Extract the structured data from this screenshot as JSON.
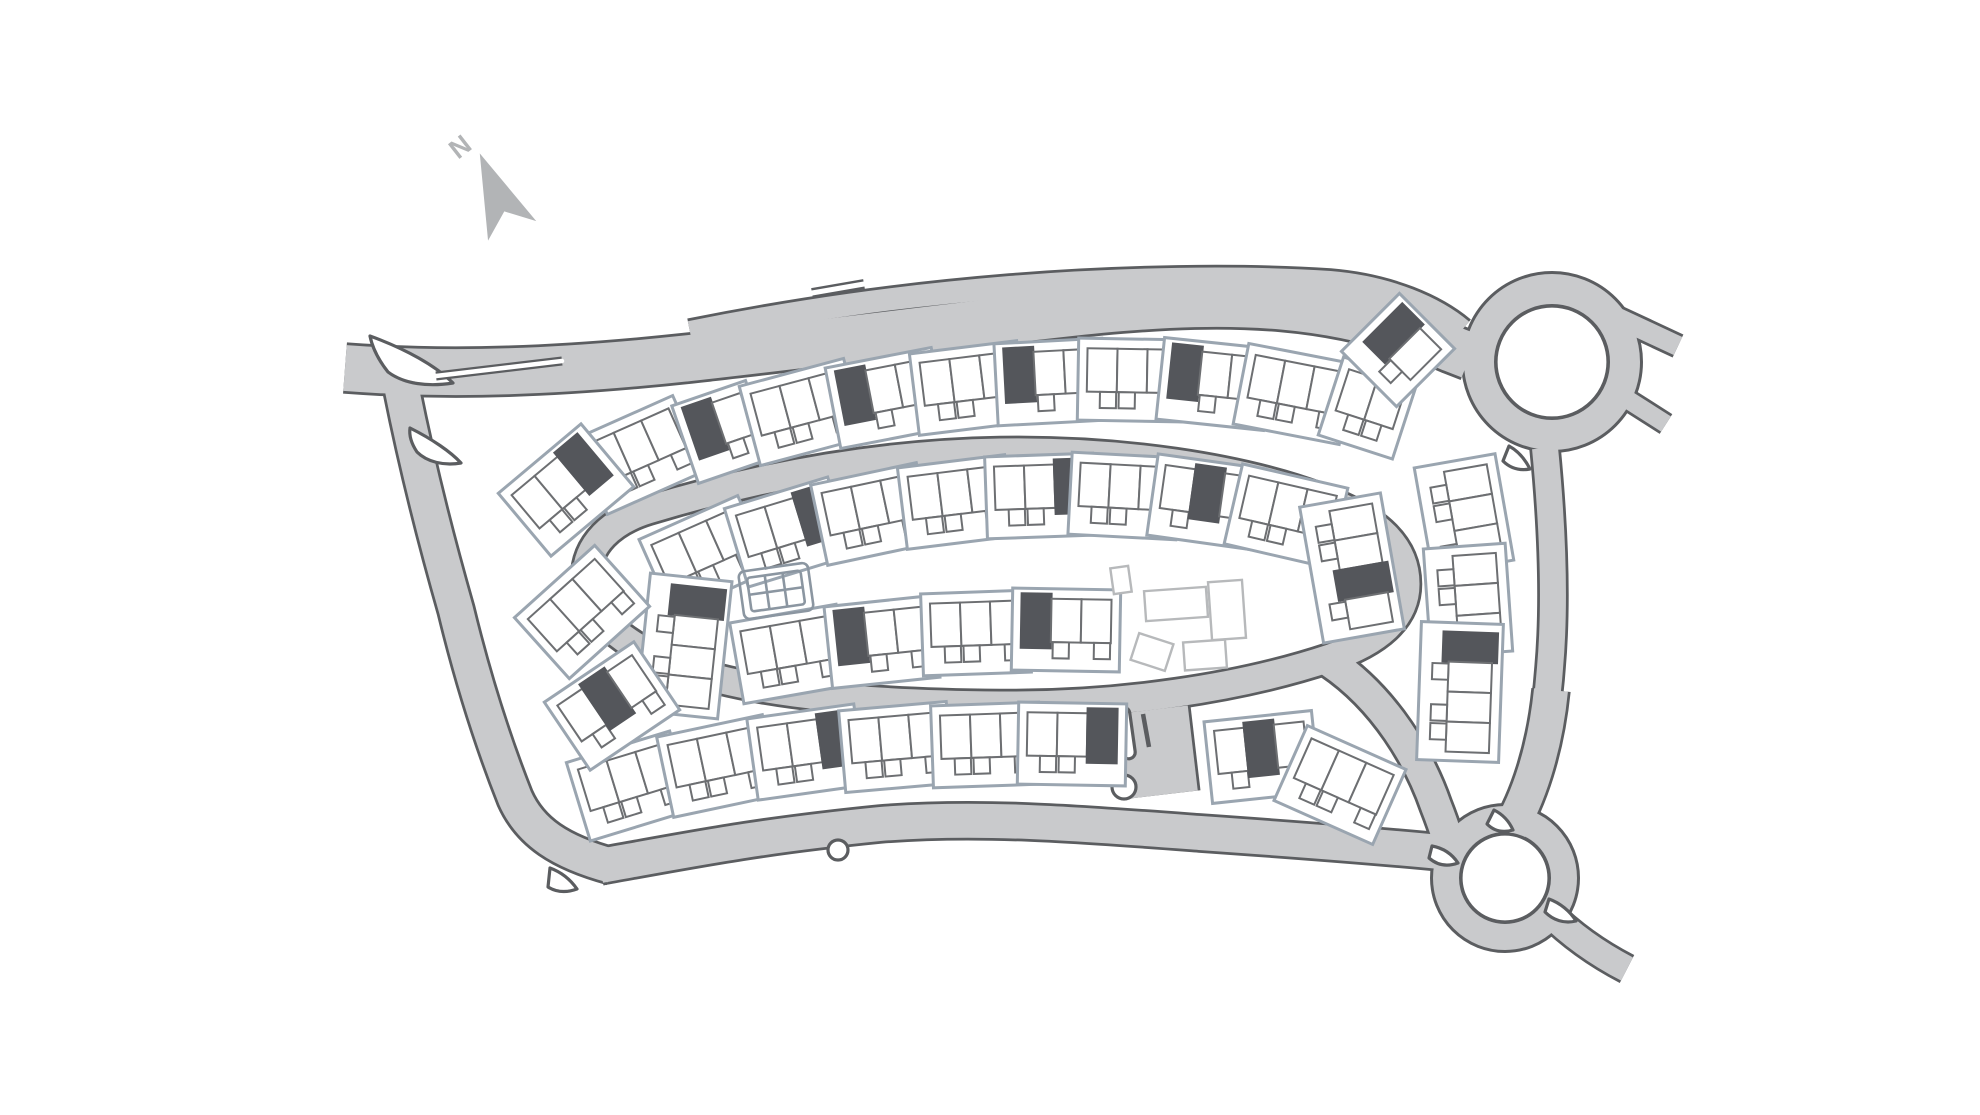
{
  "page": {
    "title": "Development site plan",
    "background": "#ffffff"
  },
  "compass": {
    "label": "N"
  },
  "colors": {
    "road_fill": "#c9cacc",
    "road_casing": "#5b5d60",
    "plot_outline": "#9aa5b0",
    "house_outline": "#6d6f72",
    "house_filled": "#54565b",
    "future_outline": "#b7b9bb",
    "play_area_outline": "#8b96a1",
    "compass": "#b2b4b6"
  },
  "site": {
    "roundabout_count": 2,
    "rows": {
      "outer_top": [
        {
          "x": 640,
          "y": 455,
          "r": -24,
          "n": 3,
          "dark": []
        },
        {
          "x": 722,
          "y": 432,
          "r": -19,
          "n": 2,
          "dark": [
            0
          ]
        },
        {
          "x": 802,
          "y": 412,
          "r": -15,
          "n": 3,
          "dark": []
        },
        {
          "x": 886,
          "y": 398,
          "r": -11,
          "n": 3,
          "dark": [
            0
          ]
        },
        {
          "x": 968,
          "y": 388,
          "r": -7,
          "n": 3,
          "dark": []
        },
        {
          "x": 1050,
          "y": 382,
          "r": -3,
          "n": 3,
          "dark": [
            0
          ]
        },
        {
          "x": 1132,
          "y": 380,
          "r": 1,
          "n": 3,
          "dark": []
        },
        {
          "x": 1214,
          "y": 384,
          "r": 6,
          "n": 3,
          "dark": [
            0
          ]
        },
        {
          "x": 1294,
          "y": 394,
          "r": 11,
          "n": 3,
          "dark": []
        },
        {
          "x": 1368,
          "y": 408,
          "r": 18,
          "n": 2,
          "dark": []
        },
        {
          "x": 1398,
          "y": 350,
          "r": 45,
          "n": 2,
          "dark": [
            0
          ]
        }
      ],
      "inner_top": [
        {
          "x": 705,
          "y": 555,
          "r": -24,
          "n": 3,
          "dark": []
        },
        {
          "x": 788,
          "y": 532,
          "r": -17,
          "n": 3,
          "dark": [
            2
          ]
        },
        {
          "x": 872,
          "y": 514,
          "r": -12,
          "n": 3,
          "dark": []
        },
        {
          "x": 956,
          "y": 502,
          "r": -7,
          "n": 3,
          "dark": []
        },
        {
          "x": 1040,
          "y": 496,
          "r": -2,
          "n": 3,
          "dark": [
            2
          ]
        },
        {
          "x": 1124,
          "y": 496,
          "r": 3,
          "n": 3,
          "dark": []
        },
        {
          "x": 1206,
          "y": 502,
          "r": 8,
          "n": 3,
          "dark": [
            1
          ]
        },
        {
          "x": 1286,
          "y": 516,
          "r": 13,
          "n": 3,
          "dark": []
        }
      ],
      "inner_east": [
        {
          "x": 1352,
          "y": 568,
          "r": 80,
          "n": 4,
          "dark": [
            2
          ]
        }
      ],
      "inner_west": [
        {
          "x": 684,
          "y": 646,
          "r": 96,
          "n": 4,
          "dark": [
            0
          ]
        }
      ],
      "inner_bottom": [
        {
          "x": 790,
          "y": 654,
          "r": -10,
          "n": 3,
          "dark": []
        },
        {
          "x": 882,
          "y": 642,
          "r": -6,
          "n": 3,
          "dark": [
            0
          ]
        },
        {
          "x": 976,
          "y": 633,
          "r": -2,
          "n": 3,
          "dark": []
        },
        {
          "x": 1066,
          "y": 630,
          "r": 1,
          "n": 3,
          "dark": [
            0
          ]
        }
      ],
      "bottom_outer": [
        {
          "x": 630,
          "y": 786,
          "r": -17,
          "n": 3,
          "dark": []
        },
        {
          "x": 718,
          "y": 766,
          "r": -12,
          "n": 3,
          "dark": []
        },
        {
          "x": 806,
          "y": 752,
          "r": -8,
          "n": 3,
          "dark": [
            2
          ]
        },
        {
          "x": 896,
          "y": 747,
          "r": -5,
          "n": 3,
          "dark": []
        },
        {
          "x": 986,
          "y": 745,
          "r": -2,
          "n": 3,
          "dark": []
        },
        {
          "x": 1072,
          "y": 744,
          "r": 1,
          "n": 3,
          "dark": [
            2
          ]
        }
      ],
      "se_corner": [
        {
          "x": 1262,
          "y": 757,
          "r": -6,
          "n": 3,
          "dark": [
            1
          ]
        },
        {
          "x": 1340,
          "y": 785,
          "r": 24,
          "n": 3,
          "dark": []
        }
      ],
      "right_col": [
        {
          "x": 1464,
          "y": 514,
          "r": 80,
          "n": 3,
          "dark": []
        },
        {
          "x": 1468,
          "y": 600,
          "r": 86,
          "n": 3,
          "dark": []
        },
        {
          "x": 1460,
          "y": 692,
          "r": 92,
          "n": 4,
          "dark": [
            0
          ]
        }
      ],
      "left_col": [
        {
          "x": 566,
          "y": 490,
          "r": -40,
          "n": 3,
          "dark": [
            2
          ]
        },
        {
          "x": 582,
          "y": 612,
          "r": -42,
          "n": 3,
          "dark": []
        },
        {
          "x": 612,
          "y": 706,
          "r": -34,
          "n": 3,
          "dark": [
            1
          ]
        }
      ]
    },
    "play_area": {
      "x": 776,
      "y": 591,
      "r": -8
    },
    "future_buildings": [
      {
        "x": 1121,
        "y": 580,
        "w": 18,
        "h": 26,
        "r": -8
      },
      {
        "x": 1176,
        "y": 604,
        "w": 62,
        "h": 30,
        "r": -4
      },
      {
        "x": 1227,
        "y": 610,
        "w": 34,
        "h": 58,
        "r": -4
      },
      {
        "x": 1152,
        "y": 652,
        "w": 36,
        "h": 28,
        "r": 18
      },
      {
        "x": 1205,
        "y": 655,
        "w": 42,
        "h": 28,
        "r": -4
      }
    ]
  }
}
